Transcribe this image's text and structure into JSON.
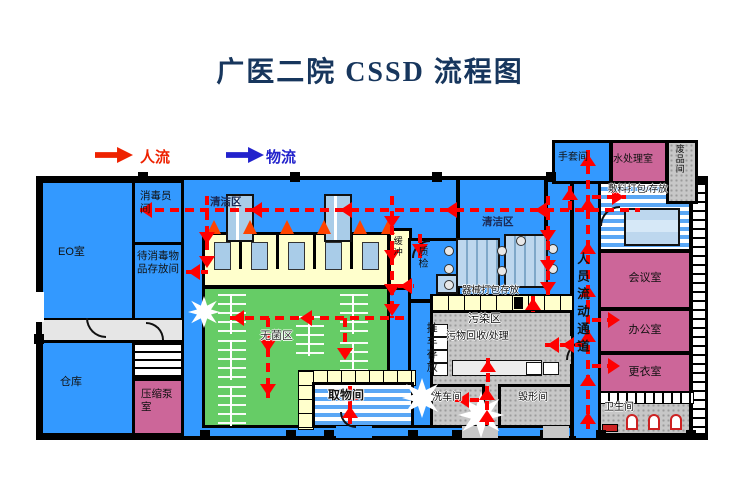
{
  "title": "广医二院 CSSD 流程图",
  "legend": {
    "people_flow": {
      "label": "人流",
      "icon": "arrow-right-icon",
      "color": "#ee2200"
    },
    "material_flow": {
      "label": "物流",
      "icon": "arrow-right-icon",
      "color": "#2222cc"
    }
  },
  "colors": {
    "floor_blue": "#3399ff",
    "sterile_green": "#66cc66",
    "room_yellow": "#ffffcc",
    "room_pink": "#cc6699",
    "corridor_gray": "#c7c7c7",
    "flow_arrow_red": "#ff0000",
    "title_navy": "#17365d",
    "wall_black": "#000000"
  },
  "rooms": {
    "eo": "EO室",
    "disinfection_staff": "消毒员间",
    "to_disinfect_storage": "待消毒物品存放间",
    "warehouse": "仓库",
    "compressor_pump": "压缩泵室",
    "clean_area_left": "清洁区",
    "buffer": "缓冲",
    "quality_check": "质检",
    "sterile_area": "无菌区",
    "pickup_room": "取物间",
    "cart_storage": "推车存放",
    "clean_area_right": "清洁区",
    "instrument_pack_storage": "器械打包存放",
    "contaminated_area": "污染区",
    "waste_recycle_handle": "污物回收/处理",
    "cart_wash_room": "洗车间",
    "destruction_room": "毁形间",
    "personnel_corridor": "人员流动通道",
    "glove_room": "手套间",
    "water_treatment": "水处理室",
    "scrap_room": "废品间",
    "dressing_pack_storage": "敷料打包/存放",
    "meeting_room": "会议室",
    "office": "办公室",
    "changing_room": "更衣室",
    "toilet": "卫生间"
  }
}
